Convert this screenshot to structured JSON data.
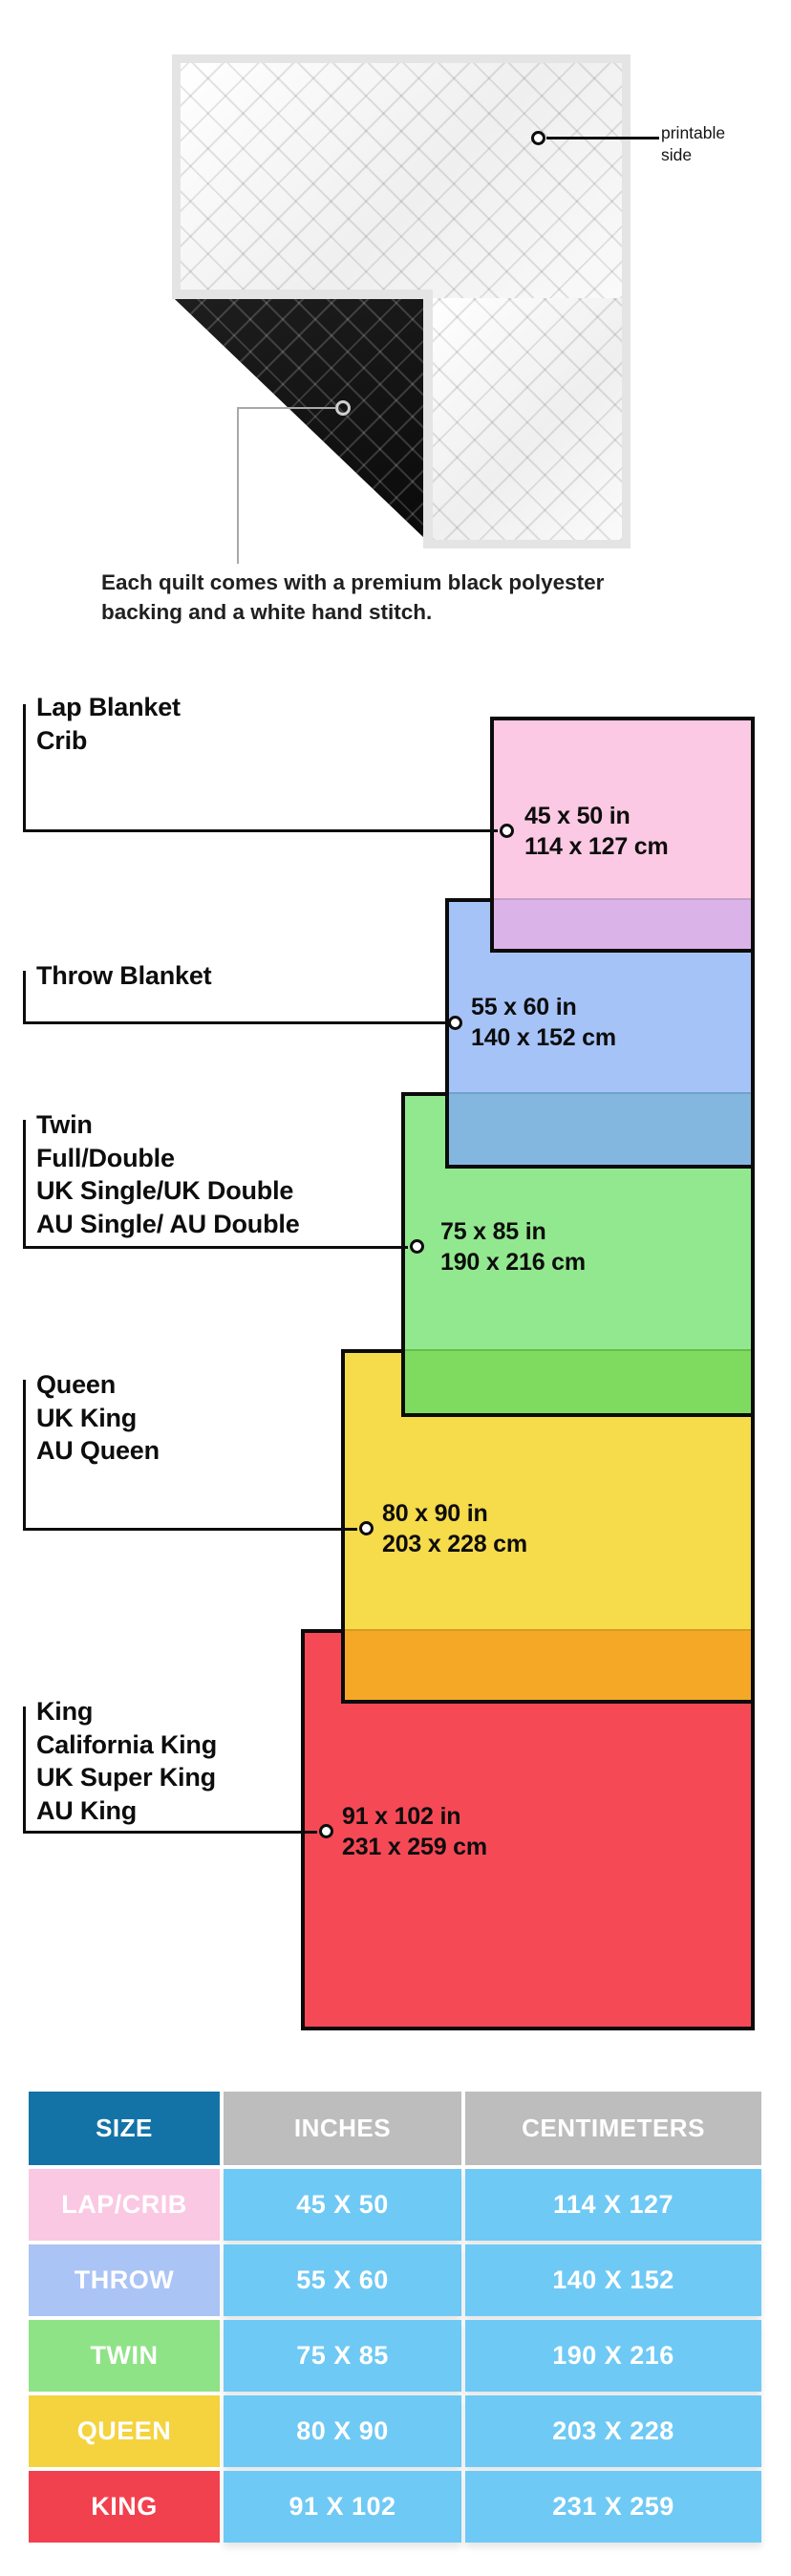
{
  "quilt": {
    "printable_line1": "printable",
    "printable_line2": "side",
    "caption_line1": "Each quilt comes with a premium black polyester",
    "caption_line2": "backing and a white hand stitch."
  },
  "diagram": {
    "sizes": [
      {
        "id": "lap-crib",
        "labels": [
          "Lap Blanket",
          "Crib"
        ],
        "inches": "45 x 50 in",
        "cm": "114 x 127 cm",
        "fill": "#FBC9E3",
        "overlap_fill": "#DAB3E9"
      },
      {
        "id": "throw",
        "labels": [
          "Throw Blanket"
        ],
        "inches": "55 x 60 in",
        "cm": "140 x 152 cm",
        "fill": "#A6C3F8",
        "overlap_fill": "#84B7E0"
      },
      {
        "id": "twin",
        "labels": [
          "Twin",
          "Full/Double",
          "UK Single/UK Double",
          "AU Single/ AU Double"
        ],
        "inches": "75 x 85 in",
        "cm": "190 x 216 cm",
        "fill": "#92E88E",
        "overlap_fill": "#7EDB60"
      },
      {
        "id": "queen",
        "labels": [
          "Queen",
          "UK King",
          "AU Queen"
        ],
        "inches": "80 x 90 in",
        "cm": "203 x 228 cm",
        "fill": "#F6DB4A",
        "overlap_fill": "#F4A826"
      },
      {
        "id": "king",
        "labels": [
          "King",
          "California King",
          "UK Super King",
          "AU King"
        ],
        "inches": "91 x 102 in",
        "cm": "231 x 259 cm",
        "fill": "#F64956",
        "overlap_fill": ""
      }
    ]
  },
  "table": {
    "headers": [
      "SIZE",
      "INCHES",
      "CENTIMETERS"
    ],
    "rows": [
      {
        "size": "LAP/CRIB",
        "inches": "45 X 50",
        "cm": "114 X 127",
        "color": "#FBC8E3"
      },
      {
        "size": "THROW",
        "inches": "55 X 60",
        "cm": "140 X 152",
        "color": "#AAC4F5"
      },
      {
        "size": "TWIN",
        "inches": "75 X 85",
        "cm": "190 X 216",
        "color": "#8FE387"
      },
      {
        "size": "QUEEN",
        "inches": "80 X 90",
        "cm": "203 X 228",
        "color": "#F4D33F"
      },
      {
        "size": "KING",
        "inches": "91 X 102",
        "cm": "231 X 259",
        "color": "#F2414E"
      }
    ]
  },
  "colors": {
    "header_size_bg": "#1473A6",
    "header_gray_bg": "#BDBDBD",
    "table_cell_bg": "#6FC9F5",
    "border_black": "#0B0B0B",
    "quilt_binding": "#E4E4E4",
    "quilt_backing": "#131313"
  }
}
